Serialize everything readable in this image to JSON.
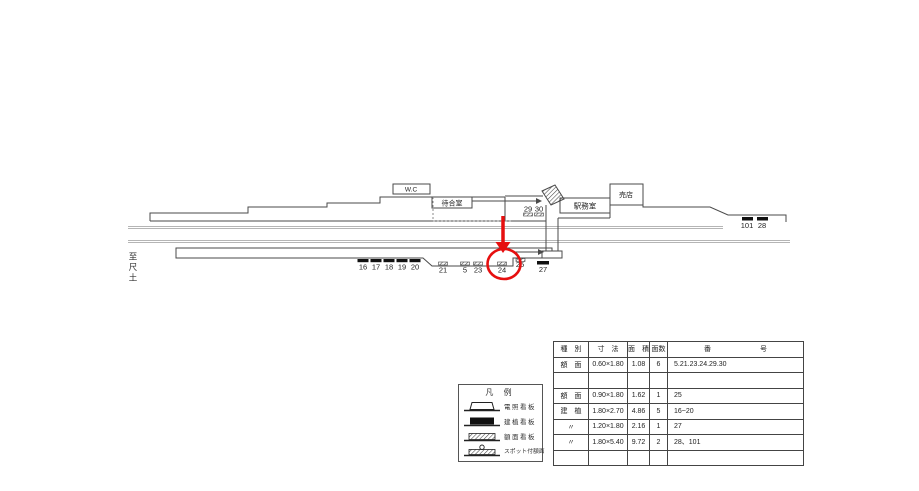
{
  "diagram": {
    "direction_label": "至尺土",
    "rooms": {
      "wc": "W.C",
      "waiting_room": "待合室",
      "station_office": "駅務室",
      "shop": "売店"
    },
    "signs": {
      "s16": "16",
      "s17": "17",
      "s18": "18",
      "s19": "19",
      "s20": "20",
      "s21": "21",
      "s5": "5",
      "s23": "23",
      "s24": "24",
      "s25": "25",
      "s27": "27",
      "s29": "29",
      "s30": "30",
      "s101": "101",
      "s28": "28"
    },
    "highlighted_sign": "24",
    "highlight_color": "#e60f0f"
  },
  "legend": {
    "title": "凡 例",
    "items": [
      {
        "label": "電照看板"
      },
      {
        "label": "建植看板"
      },
      {
        "label": "額面看板"
      },
      {
        "label": "スポット付額面"
      }
    ]
  },
  "spec_table": {
    "headers": {
      "type": "種　別",
      "size": "寸　法",
      "area": "面　積",
      "count": "面数",
      "numbers": "番　　　　　　　号"
    },
    "rows": [
      {
        "type": "額　面",
        "size": "0.60×1.80",
        "area": "1.08",
        "count": "6",
        "numbers": "5.21.23.24.29.30"
      },
      {
        "type": "",
        "size": "",
        "area": "",
        "count": "",
        "numbers": ""
      },
      {
        "type": "額　面",
        "size": "0.90×1.80",
        "area": "1.62",
        "count": "1",
        "numbers": "25"
      },
      {
        "type": "建　植",
        "size": "1.80×2.70",
        "area": "4.86",
        "count": "5",
        "numbers": "16~20"
      },
      {
        "type": "〃",
        "size": "1.20×1.80",
        "area": "2.16",
        "count": "1",
        "numbers": "27"
      },
      {
        "type": "〃",
        "size": "1.80×5.40",
        "area": "9.72",
        "count": "2",
        "numbers": "28、101"
      },
      {
        "type": "",
        "size": "",
        "area": "",
        "count": "",
        "numbers": ""
      }
    ]
  }
}
